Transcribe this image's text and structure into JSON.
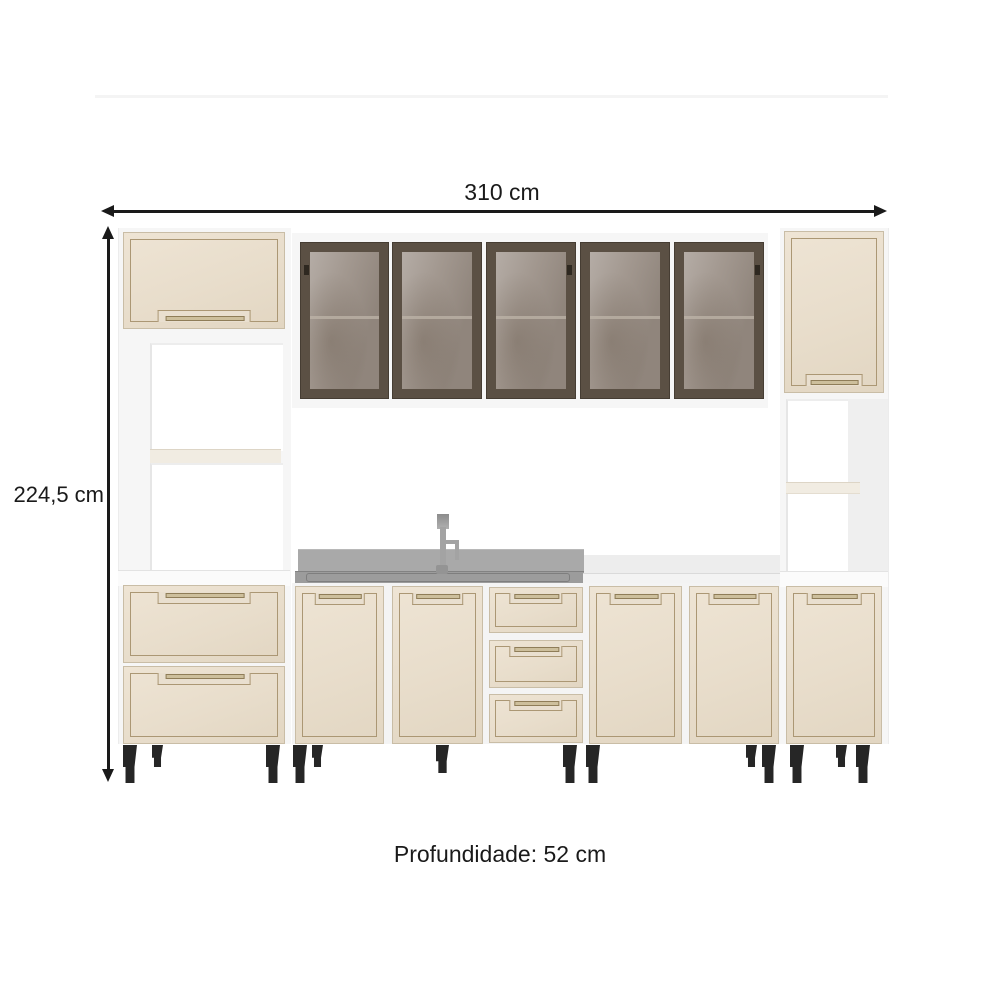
{
  "title": "Kitchen cabinet set dimension diagram",
  "labels": {
    "width": "310 cm",
    "height": "224,5 cm",
    "depth": "Profundidade: 52 cm"
  },
  "colors": {
    "arrow": "#1a1a1a",
    "text": "#1a1a1a",
    "door_cream": "#e8ddcb",
    "door_trim": "#ab9774",
    "cabinet_white": "#f6f6f6",
    "glass_frame": "#5b5044",
    "glass_pane": "#9c9188",
    "counter_gray": "#9c9c9c",
    "leg_black": "#262626",
    "background": "#ffffff"
  },
  "structure": {
    "upper_glass_doors": 5,
    "left_tower": {
      "flip_doors": 1,
      "open_niches": 2,
      "drawers": 2
    },
    "right_tower": {
      "top_doors": 1,
      "open_niches": 1,
      "base_doors": 1
    },
    "base_row": {
      "doors": 4,
      "drawers": 3
    },
    "has_sink": true,
    "has_faucet": true
  }
}
